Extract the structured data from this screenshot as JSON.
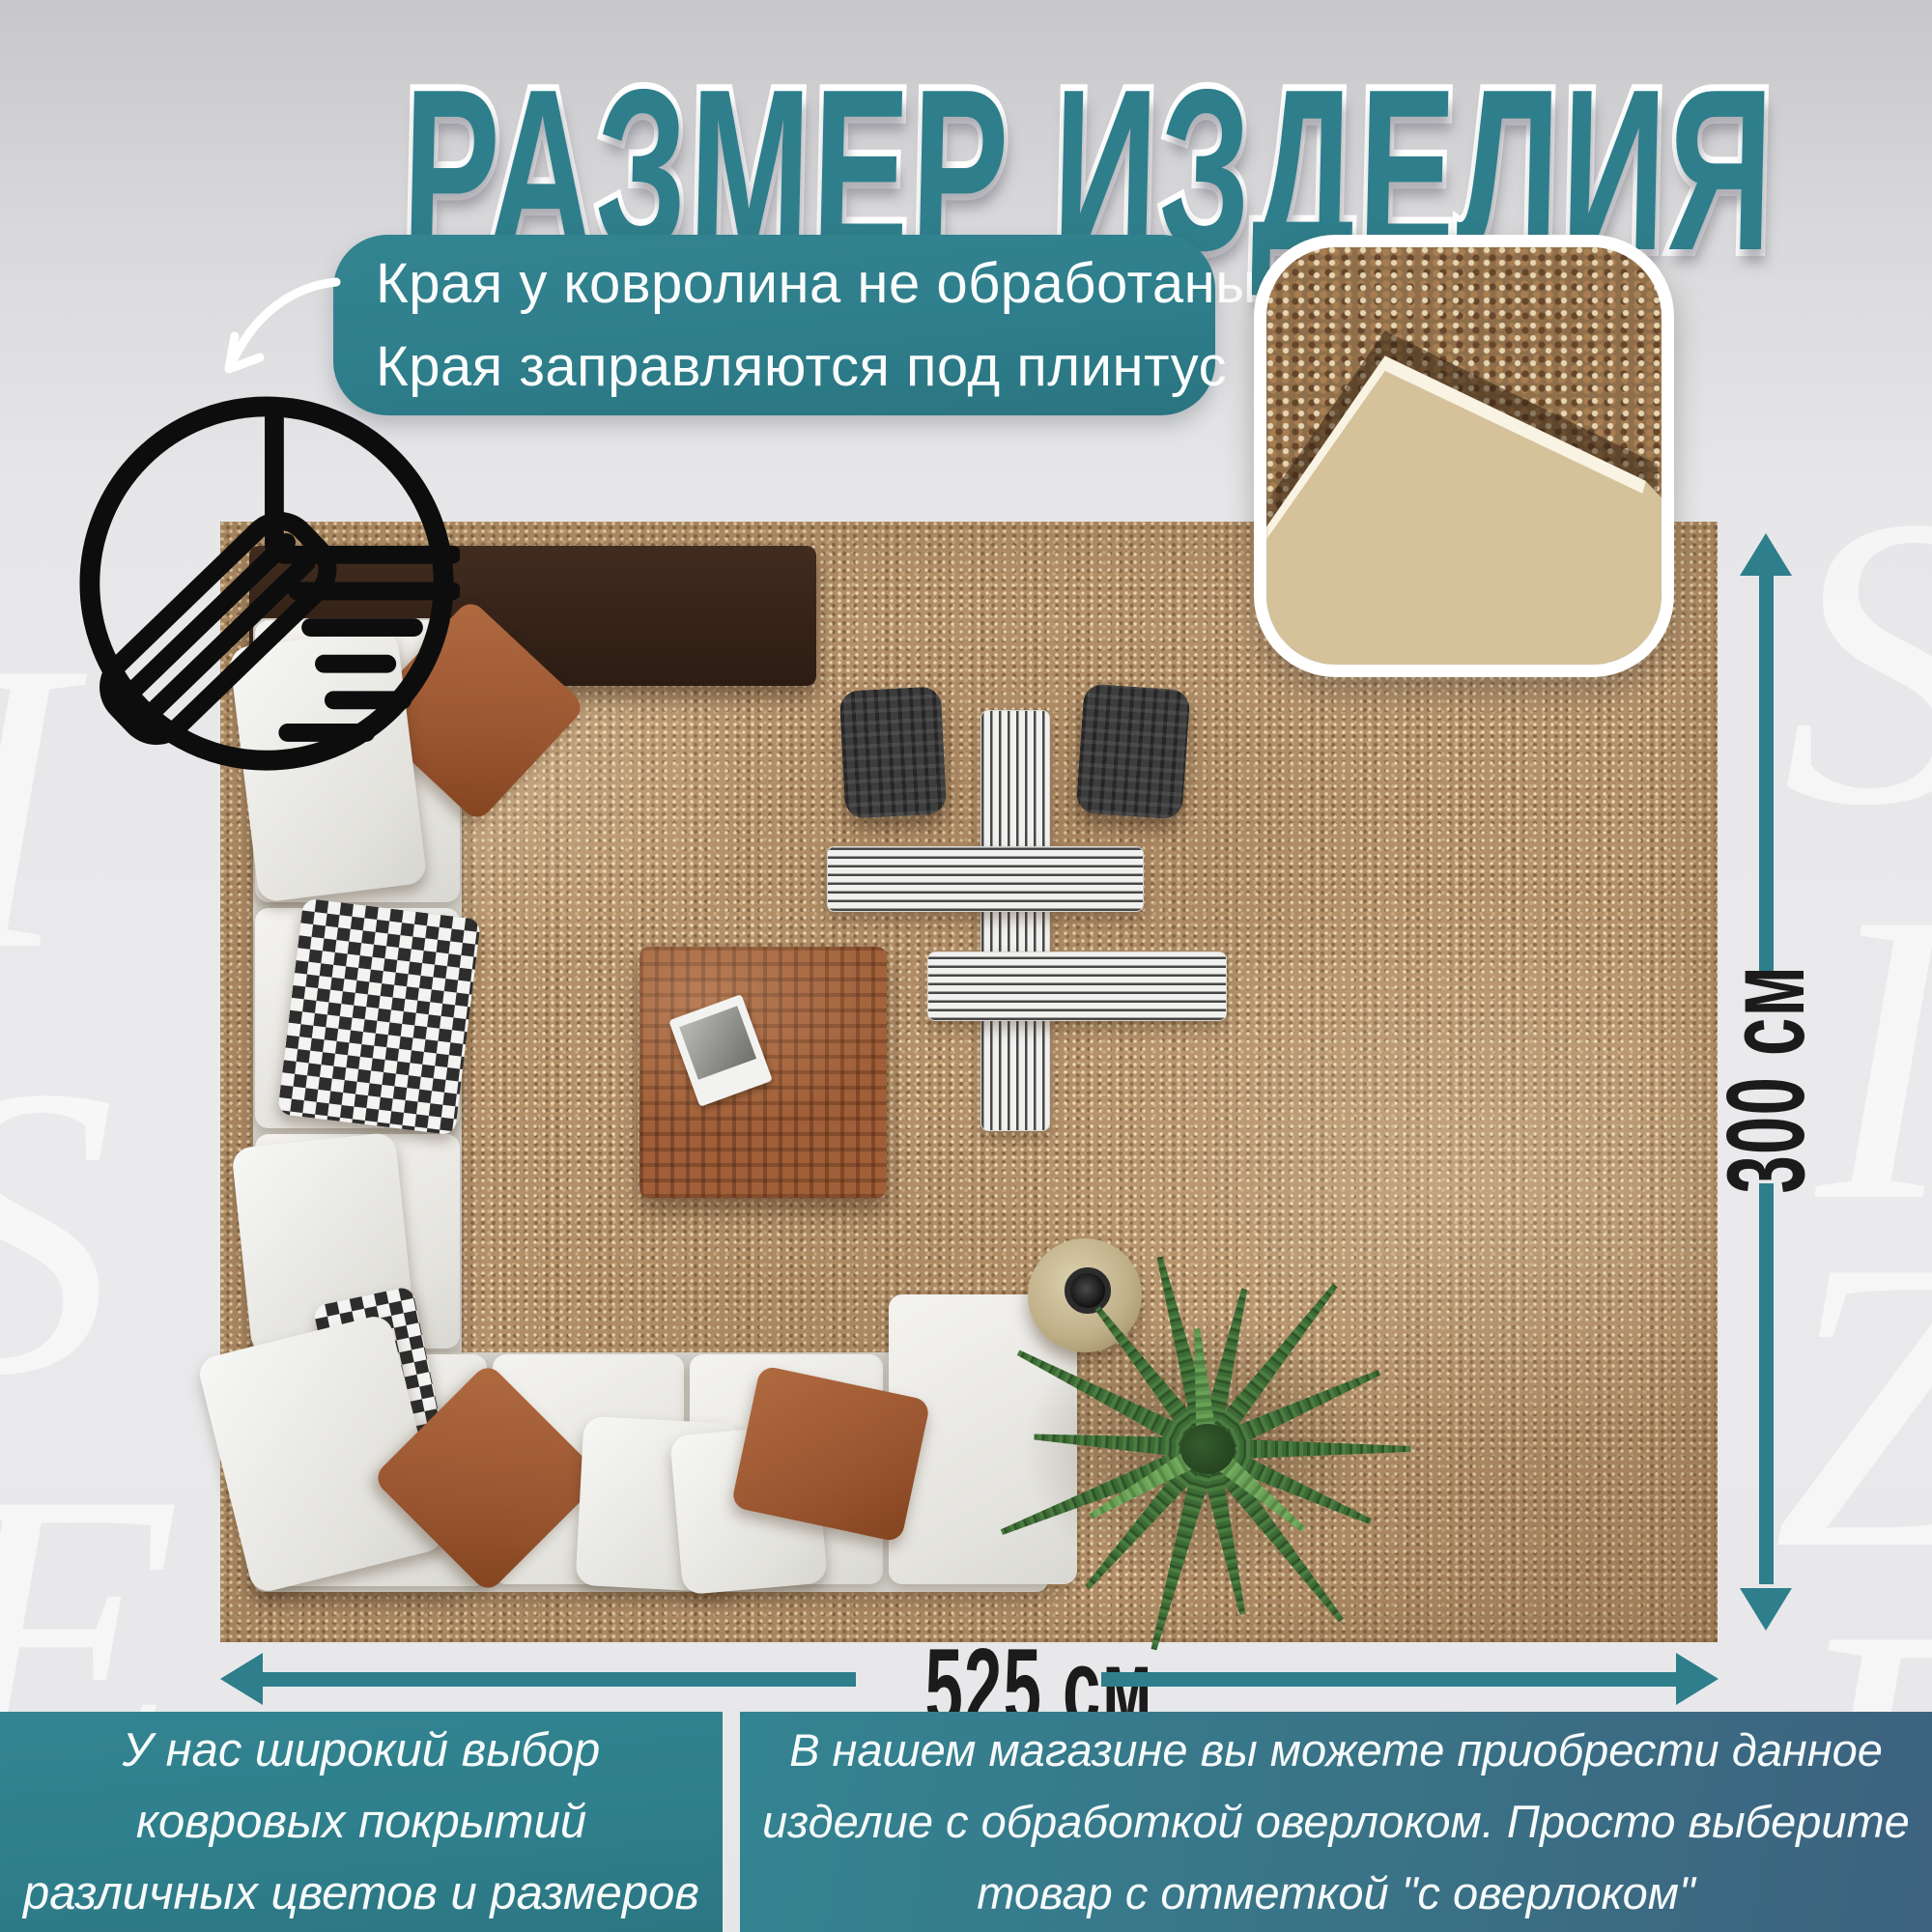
{
  "title": "РАЗМЕР ИЗДЕЛИЯ",
  "callout": {
    "line1": "Края у ковролина не обработаны",
    "line2": "Края заправляются под плинтус"
  },
  "dimensions": {
    "width": "525 см",
    "height": "300 см"
  },
  "info_left": {
    "line1": "У нас широкий выбор",
    "line2": "ковровых покрытий",
    "line3": "различных цветов и размеров"
  },
  "info_right": {
    "line1": "В нашем магазине вы можете приобрести данное",
    "line2": "изделие с обработкой оверлоком. Просто выберите",
    "line3": "товар с отметкой \"с оверлоком\""
  },
  "watermark": {
    "l1": "S",
    "l2": "I",
    "l3": "Z",
    "l4": "E",
    "l5": "S",
    "l6": "E",
    "l7": "I"
  },
  "icons": {
    "edge_detail": "carpet-edge-under-plinth-icon",
    "pointer": "curved-arrow-icon",
    "width_arrow": "horizontal-dimension-arrow",
    "height_arrow": "vertical-dimension-arrow"
  },
  "colors": {
    "accent": "#2e7e8b",
    "accent_dark": "#3c627f",
    "bg": "#e9e9eb",
    "carpet": "#b3906a",
    "label_color": "#1b1b1b"
  }
}
